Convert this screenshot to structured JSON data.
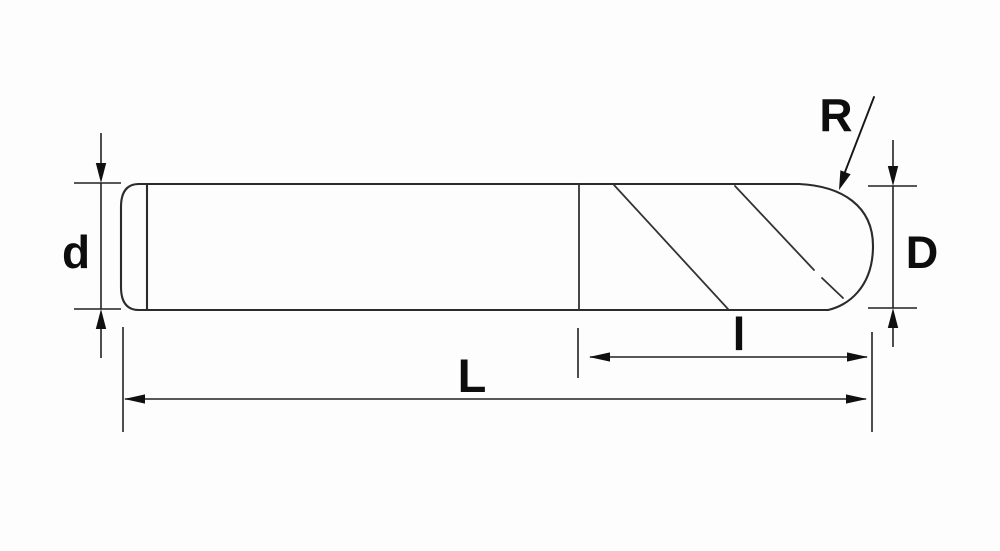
{
  "diagram": {
    "type": "technical-drawing",
    "subject": "Ball nose end mill outline with dimension annotations",
    "colors": {
      "background": "#fdfdfd",
      "line": "#2b2b2b",
      "text": "#0d0d0d"
    },
    "labels": {
      "shank_diameter": "d",
      "cutting_diameter": "D",
      "ball_radius": "R",
      "flute_length": "l",
      "overall_length": "L"
    }
  }
}
